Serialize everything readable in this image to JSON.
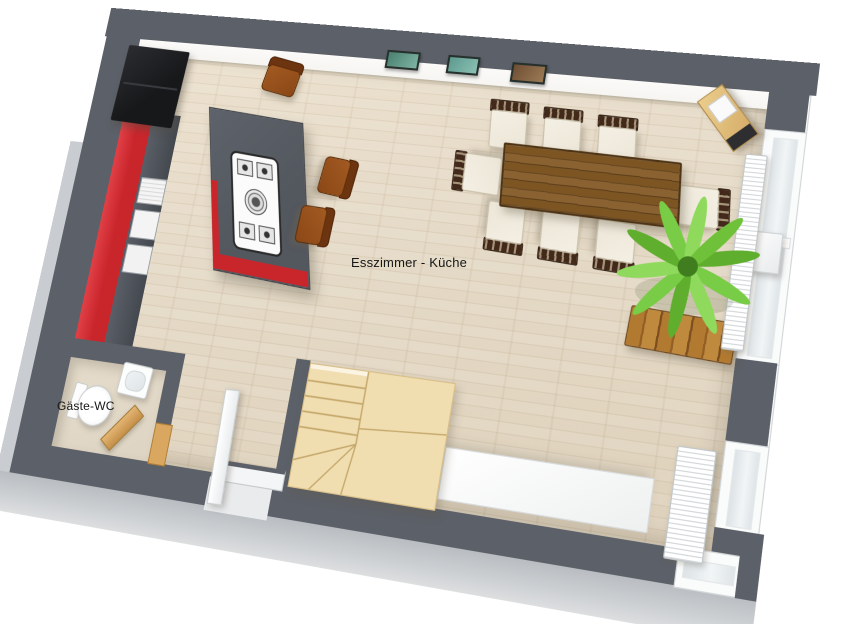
{
  "meta": {
    "type": "3d-floor-plan-render",
    "view": "top-down perspective"
  },
  "labels": {
    "dining_kitchen": "Esszimmer - Küche",
    "guest_wc": "Gäste-WC"
  },
  "palette": {
    "wall": "#5c6068",
    "wall-outer": "#c7cacd",
    "wall-inner": "#f6f5f2",
    "floor": "#e4d8c4",
    "floor-wc": "#ded4c3",
    "accent-red": "#c9262c",
    "island-top": "#53575e",
    "table-wood": "#7a5424",
    "stairs-wood": "#f0ddb0",
    "stairs-line": "#c5a86b",
    "plant-green": "#6fc13a",
    "cushion": "#ece6d8",
    "chair-frame": "#42291a",
    "stool-brown": "#8a4716",
    "bench-wood": "#b27a30",
    "door-wood": "#d9a75f",
    "fixture-white": "#fbfbfb",
    "fridge-black": "#17181a",
    "label-color": "#161616"
  },
  "inventory": {
    "rooms": [
      "Esszimmer - Küche",
      "Gäste-WC"
    ],
    "dining_chairs": 8,
    "bar_stools": 3,
    "windows": 2,
    "radiators": 2,
    "wall_pictures": 3,
    "items": [
      "refrigerator",
      "red kitchen cabinet run",
      "kitchen island with gas cooktop",
      "dining table",
      "palm plant",
      "wooden bench",
      "winder staircase",
      "white sideboard",
      "toilet",
      "washbasin",
      "corner rack",
      "entry door",
      "wc wooden door",
      "door mat"
    ]
  }
}
